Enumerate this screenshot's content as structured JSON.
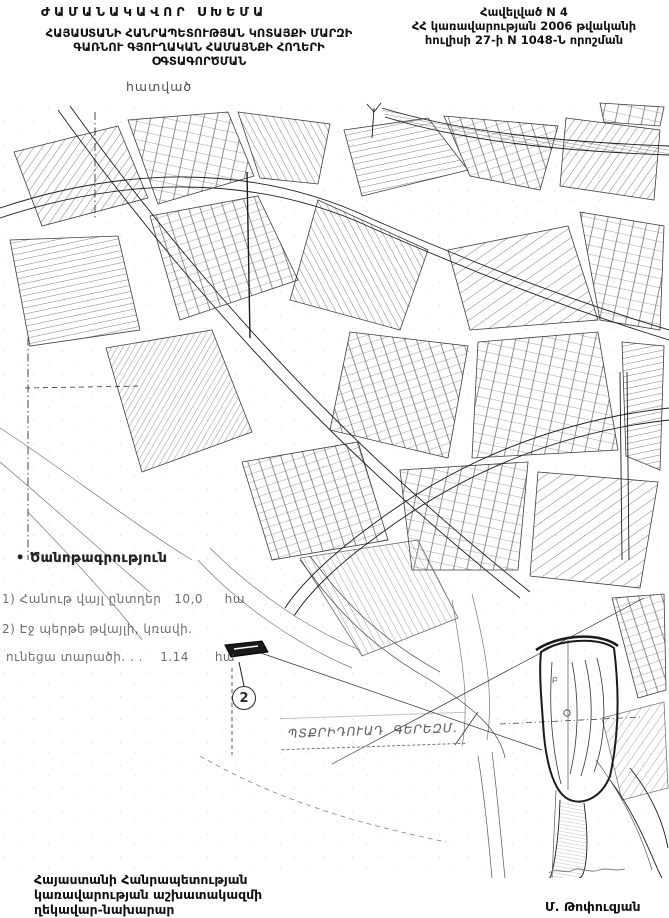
{
  "page": {
    "background": "#ffffff",
    "ink": "#1b1b1b"
  },
  "header": {
    "title": "ԺԱՄԱՆԱԿԱՎՈՐ ՍԽԵՄԱ",
    "subtitle_lines": [
      "ՀԱՅԱՍՏԱՆԻ ՀԱՆՐԱՊԵՏՈՒԹՅԱՆ ԿՈՏԱՅՔԻ ՄԱՐԶԻ",
      "ԳԱՌՆՈՒ ԳՅՈՒՂԱԿԱՆ ՀԱՄԱՅՆՔԻ ՀՈՂԵՐԻ",
      "ՕԳՏԱԳՈՐԾՄԱՆ"
    ],
    "section_label": "հատված",
    "appendix_lines": [
      "Հավելված N 4",
      "ՀՀ կառավարության 2006 թվականի",
      "հուլիսի 27-ի N 1048-Ն որոշման"
    ]
  },
  "legend": {
    "bullet": "•",
    "heading": "Ծանոթագրություն",
    "items": [
      "1) Հանութ վայլ ընտղեր   10,0     հա",
      "2) Էջ պերթե թվայլի, կռավի.",
      "ունեցա տարածի. . .    1.14      հա"
    ]
  },
  "map": {
    "marker_number": "2",
    "cemetery_label": "ՊՏՔՐԻԴՈՒԱԴ  ԳԵՐԵԶՄ.",
    "area_letter": "Բ"
  },
  "footer": {
    "left_lines": [
      "Հայաստանի Հանրապետության",
      "կառավարության աշխատակազմի",
      "ղեկավար-նախարար"
    ],
    "signature_name": "Մ. Թոփուզյան"
  }
}
